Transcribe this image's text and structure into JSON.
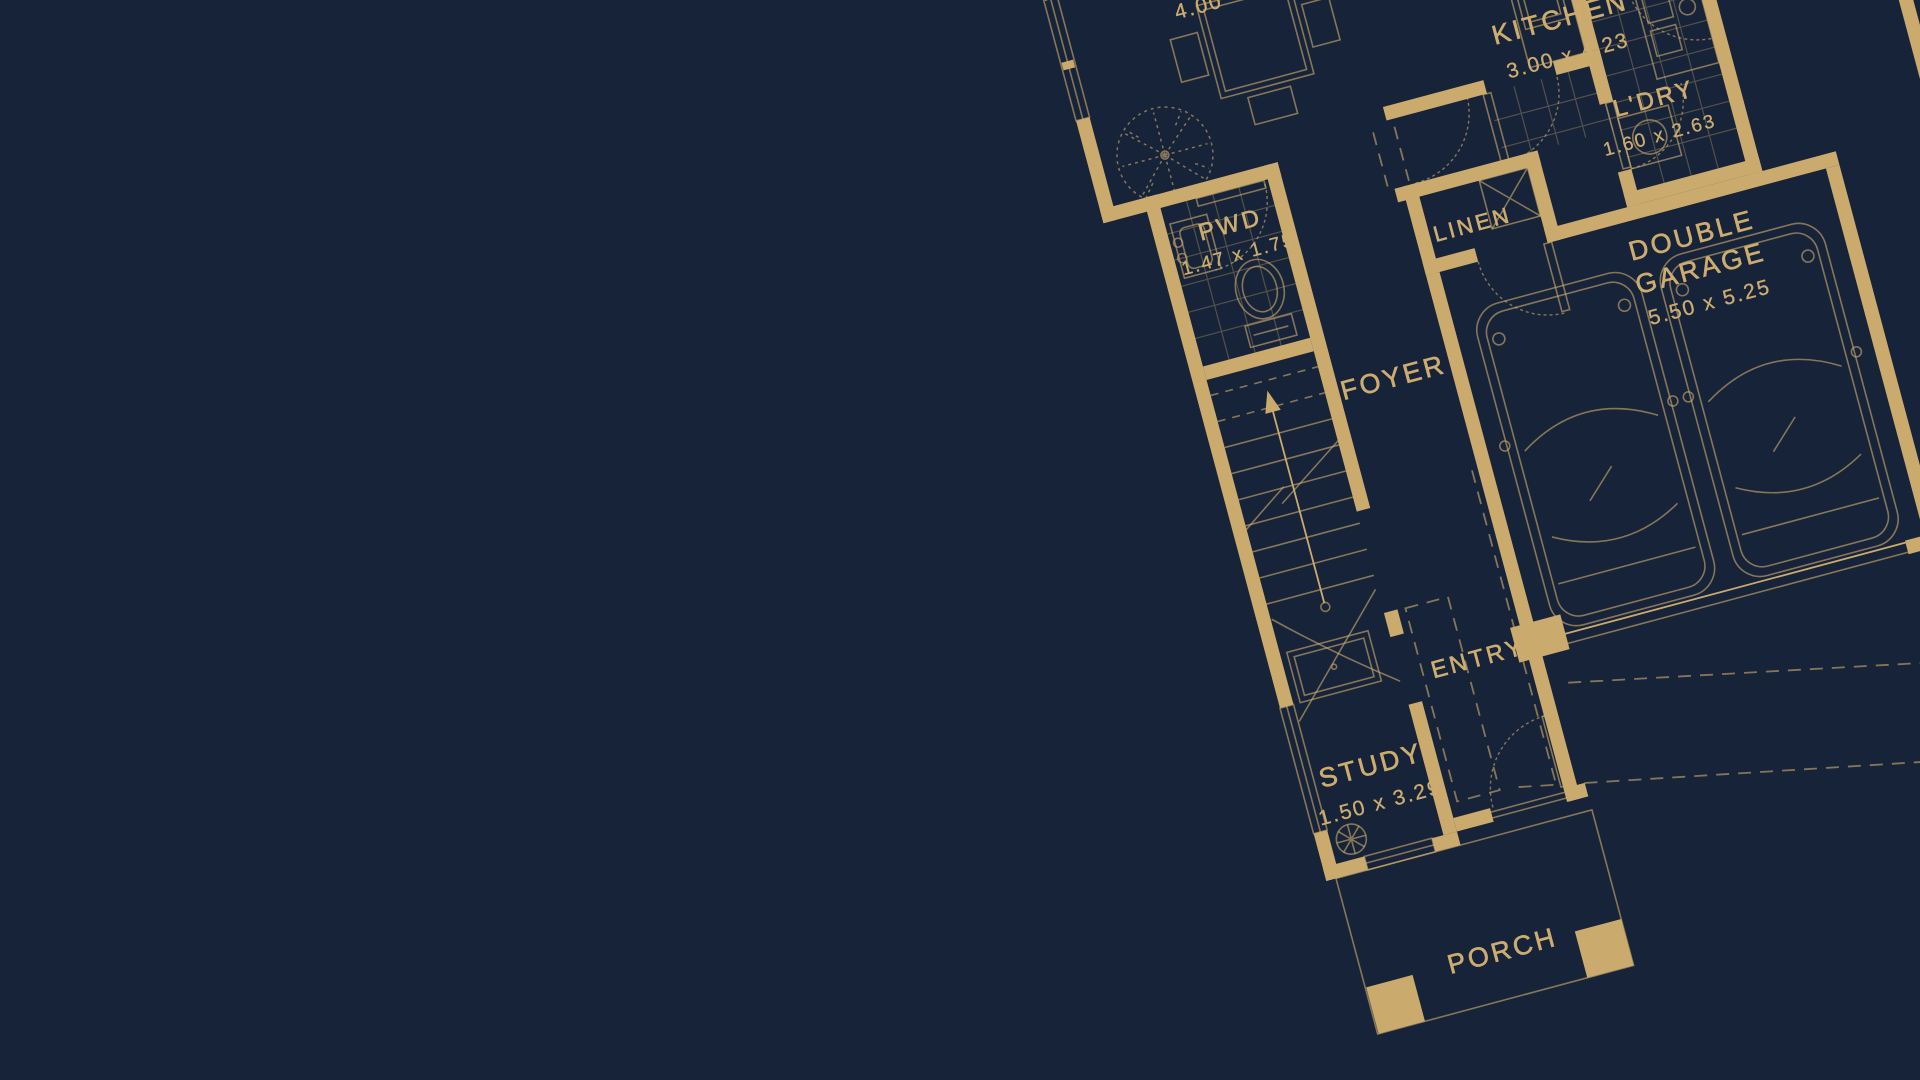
{
  "canvas": {
    "width": 1920,
    "height": 1080
  },
  "colors": {
    "background": "#172338",
    "gold": "#CBAA6E",
    "gold-dim": "rgba(203,170,110,0.62)",
    "gold-faint": "rgba(203,170,110,0.34)",
    "text": "#CDAC70"
  },
  "plan": {
    "type": "architectural-floor-plan-blueprint",
    "style": "gold linework on navy, rotated -15 degrees, cropped top and right",
    "rooms": [
      {
        "id": "meals",
        "name": "",
        "dims": "4.00"
      },
      {
        "id": "kitchen",
        "name": "KITCHEN",
        "dims": "3.00 x 4.23"
      },
      {
        "id": "laundry",
        "name": "L'DRY",
        "dims": "1.60 x 2.63"
      },
      {
        "id": "linen",
        "name": "LINEN",
        "dims": ""
      },
      {
        "id": "powder",
        "name": "PWD",
        "dims": "1.47 x 1.75"
      },
      {
        "id": "foyer",
        "name": "FOYER",
        "dims": ""
      },
      {
        "id": "garage",
        "name": "DOUBLE GARAGE",
        "name_line1": "DOUBLE",
        "name_line2": "GARAGE",
        "dims": "5.50 x 5.25"
      },
      {
        "id": "entry",
        "name": "ENTRY",
        "dims": ""
      },
      {
        "id": "study",
        "name": "STUDY",
        "dims": "1.50 x 3.29"
      },
      {
        "id": "porch",
        "name": "PORCH",
        "dims": ""
      }
    ],
    "symbols": [
      "dining-table",
      "tree",
      "toilet",
      "basin",
      "staircase",
      "stair-arrow",
      "desk",
      "ceiling-fan",
      "car",
      "car",
      "garage-door",
      "door-swing-arcs",
      "windows",
      "linen-cross",
      "laundry-trough",
      "washer",
      "porch-piers",
      "driveway-dashed-lines"
    ]
  }
}
